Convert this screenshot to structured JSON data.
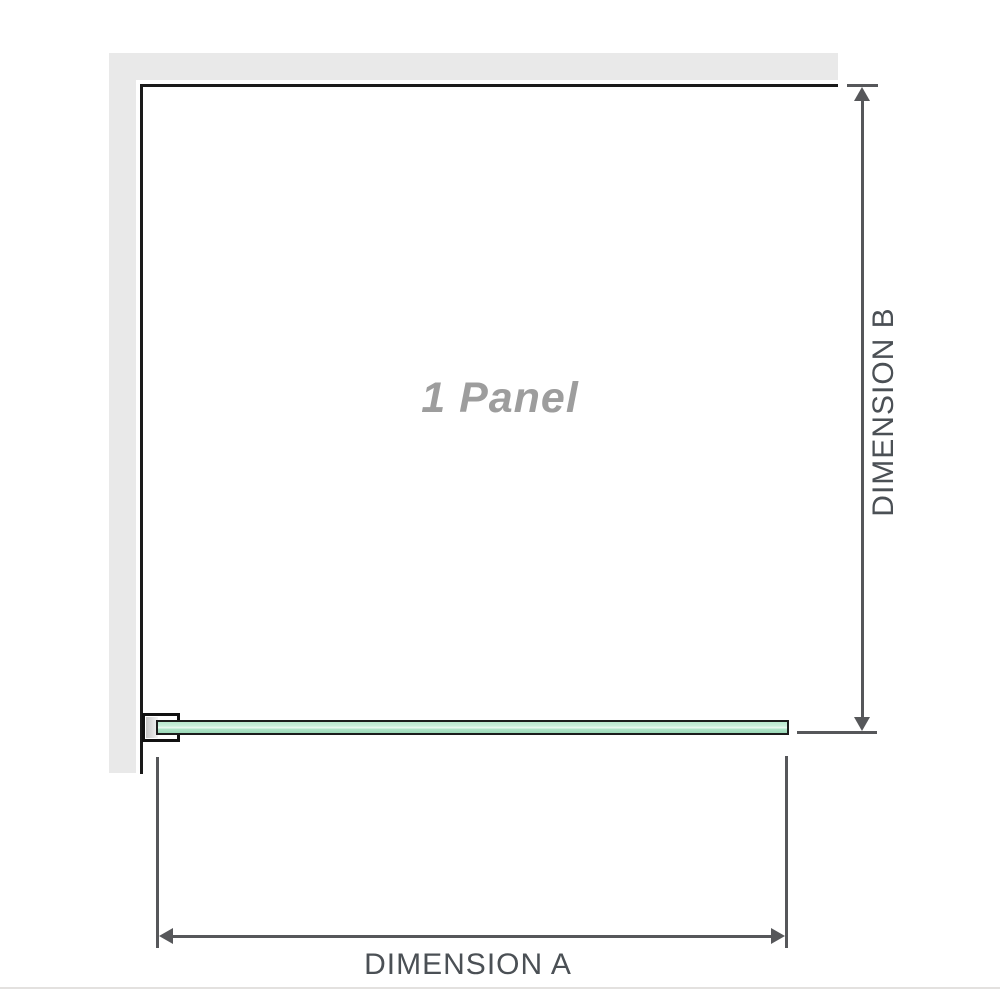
{
  "diagram": {
    "panel": {
      "label": "1 Panel"
    },
    "dimensions": {
      "a": {
        "label": "DIMENSION A",
        "orientation": "horizontal"
      },
      "b": {
        "label": "DIMENSION B",
        "orientation": "vertical"
      }
    },
    "parts": {
      "wall": "wall",
      "bracket": "wall-bracket",
      "glass": "glass-panel"
    },
    "colors": {
      "wall": "#e9e9e9",
      "panel_border": "#1a1a1a",
      "glass_green": "#aee3c7",
      "glass_highlight": "#ecf9f2",
      "glass_border": "#1c1c1c",
      "dimension_line": "#56575a",
      "dimension_text": "#4b5055",
      "panel_label_text": "#9d9d9d",
      "divider": "#e3e1df"
    }
  }
}
